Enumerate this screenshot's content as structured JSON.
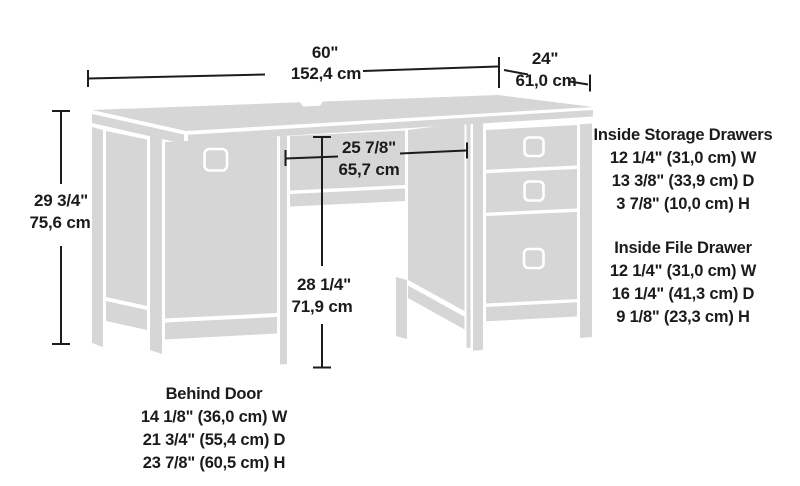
{
  "title": "Desk dimension diagram",
  "colors": {
    "background": "#ffffff",
    "desk_fill": "#d6d6d6",
    "seam": "#ffffff",
    "dimension_line": "#1c1c1c",
    "text": "#1b1b1b"
  },
  "dimensions": {
    "overall_width": {
      "inches": "60\"",
      "metric": "152,4 cm"
    },
    "overall_depth": {
      "inches": "24\"",
      "metric": "61,0 cm"
    },
    "overall_height": {
      "inches": "29 3/4\"",
      "metric": "75,6 cm"
    },
    "kneehole_width": {
      "inches": "25 7/8\"",
      "metric": "65,7 cm"
    },
    "kneehole_height": {
      "inches": "28 1/4\"",
      "metric": "71,9 cm"
    }
  },
  "spec_blocks": {
    "storage_drawers": {
      "title": "Inside Storage Drawers",
      "lines": [
        "12 1/4\" (31,0 cm) W",
        "13 3/8\" (33,9 cm) D",
        "3 7/8\" (10,0 cm) H"
      ]
    },
    "file_drawer": {
      "title": "Inside File Drawer",
      "lines": [
        "12 1/4\" (31,0 cm) W",
        "16 1/4\" (41,3 cm) D",
        "9 1/8\" (23,3 cm) H"
      ]
    },
    "behind_door": {
      "title": "Behind Door",
      "lines": [
        "14 1/8\" (36,0 cm) W",
        "21 3/4\" (55,4 cm) D",
        "23 7/8\" (60,5 cm) H"
      ]
    }
  }
}
